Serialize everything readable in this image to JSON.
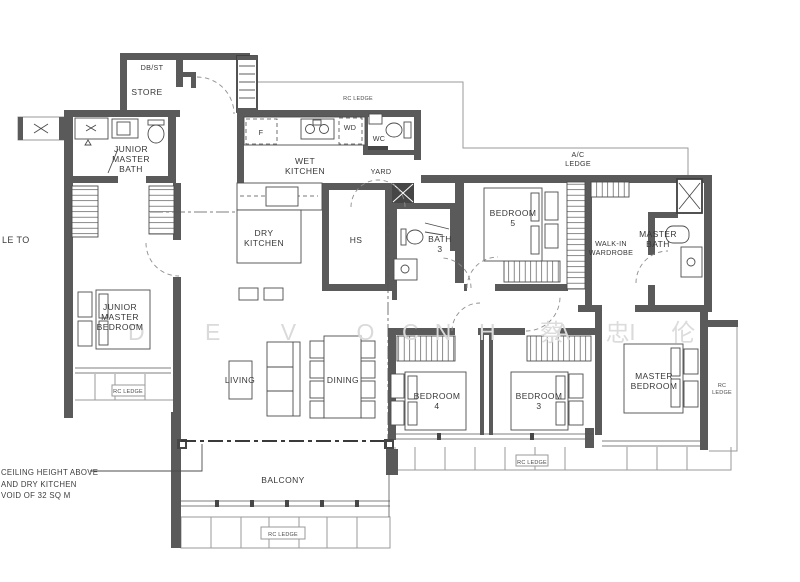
{
  "colors": {
    "wall_gray": "#5a5a5a",
    "label_color": "#383838",
    "ledge_gray": "#9a9a9a",
    "watermark_gray": "#dadada"
  },
  "labels": {
    "dbst": "DB/ST",
    "store": "STORE",
    "jmb1": "JUNIOR",
    "jmb2": "MASTER",
    "jmb3": "BATH",
    "f": "F",
    "wet1": "WET",
    "wet2": "KITCHEN",
    "wd": "WD",
    "wc": "WC",
    "yard": "YARD",
    "rc_top": "RC LEDGE",
    "ac1": "A/C",
    "ac2": "LEDGE",
    "dry1": "DRY",
    "dry2": "KITCHEN",
    "hs": "HS",
    "bath3_1": "BATH",
    "bath3_2": "3",
    "b5_1": "BEDROOM",
    "b5_2": "5",
    "wiw1": "WALK-IN",
    "wiw2": "WARDROBE",
    "mbath1": "MASTER",
    "mbath2": "BATH",
    "jmbr1": "JUNIOR",
    "jmbr2": "MASTER",
    "jmbr3": "BEDROOM",
    "living": "LIVING",
    "dining": "DINING",
    "b4_1": "BEDROOM",
    "b4_2": "4",
    "b3_1": "BEDROOM",
    "b3_2": "3",
    "mbr1": "MASTER",
    "mbr2": "BEDROOM",
    "balcony": "BALCONY",
    "rc_left": "RC LEDGE",
    "rc_bottom": "RC LEDGE",
    "rc_bottom_right": "RC LEDGE",
    "rc_right1": "RC",
    "rc_right2": "LEDGE"
  },
  "annotations": {
    "left_cut_text": "LE TO",
    "note_line1": "CEILING HEIGHT ABOVE",
    "note_line2": "AND DRY KITCHEN",
    "note_line3": "VOID OF 32 SQ M"
  },
  "watermark": {
    "part1": "D E V O N",
    "part2": "C H A I",
    "part3": "蔡 忠 伦"
  }
}
